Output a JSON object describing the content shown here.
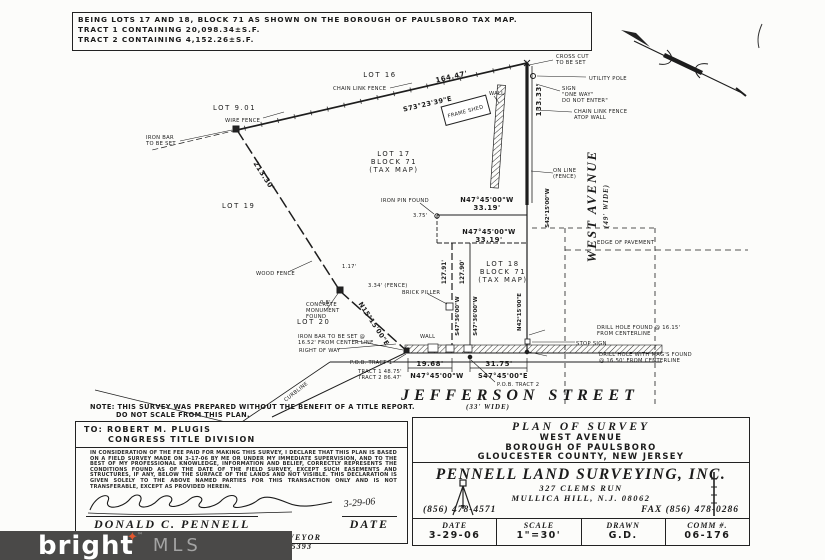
{
  "header": {
    "line1": "BEING LOTS 17 AND 18, BLOCK 71 AS SHOWN ON THE BOROUGH OF PAULSBORO TAX MAP.",
    "line2": "TRACT 1 CONTAINING 20,098.34±S.F.",
    "line3": "TRACT 2 CONTAINING 4,152.26±S.F."
  },
  "drawing": {
    "labels": {
      "l_lot16": "LOT 16",
      "l_clf": "CHAIN LINK FENCE",
      "l_16447": "164.47'",
      "l_s7323": "S73°23'39\"E",
      "l_lot901": "LOT 9.01",
      "l_wirefence": "WIRE FENCE",
      "l_frameshed": "FRAME SHED",
      "l_wall1": "WALL",
      "l_crosscut1": "CROSS CUT",
      "l_crosscut2": "TO BE SET",
      "l_utilpole": "UTILITY POLE",
      "l_sign1": "SIGN",
      "l_sign2": "\"ONE WAY\"",
      "l_sign3": "DO NOT ENTER\"",
      "l_clfwall1": "CHAIN LINK FENCE",
      "l_clfwall2": "ATOP WALL",
      "l_13333": "133.33'",
      "l_ironbar1a": "IRON BAR",
      "l_ironbar1b": "TO BE SET",
      "l_21330": "213.30'",
      "l_lot17a": "LOT 17",
      "l_lot17b": "BLOCK 71",
      "l_lot17c": "(TAX MAP)",
      "l_lot19": "LOT 19",
      "l_online1": "ON LINE",
      "l_online2": "(FENCE)",
      "l_s4215": "S42°15'00\"W",
      "l_westave": "WEST AVENUE",
      "l_westavewide": "(49' WIDE)",
      "l_edgepave": "EDGE OF PAVEMENT",
      "l_ironpin": "IRON PIN FOUND",
      "l_375": "3.75'",
      "l_n4745a": "N47°45'00\"W",
      "l_3319a": "33.19'",
      "l_n4745b": "N47°45'00\"W",
      "l_3319b": "33.19'",
      "l_lot18a": "LOT 18",
      "l_lot18b": "BLOCK 71",
      "l_lot18c": "(TAX MAP)",
      "l_woodfence": "WOOD FENCE",
      "l_brick": "BRICK PILLER",
      "l_n1515": "N15°15'00\"E",
      "l_concmon1": "CONCRETE",
      "l_concmon2": "MONUMENT",
      "l_concmon3": "FOUND",
      "l_lot20": "LOT 20",
      "l_ironbar2a": "IRON BAR TO BE SET @",
      "l_ironbar2b": "16.52' FROM CENTER LINE",
      "l_row": "RIGHT OF WAY",
      "l_117": "1.17'",
      "l_334": "3.34' (FENCE)",
      "l_08": "0.8'",
      "l_12791": "127.91'",
      "l_12790": "127.90'",
      "l_s4736a": "S47°36'00\"W",
      "l_s4736b": "S47°36'00\"W",
      "l_n4215": "N42°15'00\"E",
      "l_wall2": "WALL",
      "l_pob1": "P.O.B. TRACT 1",
      "l_tract1": "TRACT 1  48.75'",
      "l_tract2": "TRACT 2  86.47'",
      "l_1968": "19.68'",
      "l_n4745c": "N47°45'00\"W",
      "l_3175": "31.75'",
      "l_s4745": "S47°45'00\"E",
      "l_pob2": "P.O.B. TRACT 2",
      "l_jeff": "JEFFERSON STREET",
      "l_jeffwide": "(33' WIDE)",
      "l_drill1a": "DRILL HOLE FOUND @ 16.15'",
      "l_drill1b": "FROM CENTERLINE",
      "l_stop": "STOP SIGN",
      "l_drill2a": "DRILL HOLE WITH MAG'S FOUND",
      "l_drill2b": "@ 16.50' FROM CENTERLINE",
      "l_curb": "CURBLINE"
    }
  },
  "note": {
    "line1": "NOTE: THIS SURVEY WAS PREPARED WITHOUT THE BENEFIT OF A TITLE REPORT.",
    "line2": "DO NOT SCALE FROM THIS PLAN."
  },
  "to_block": {
    "line1": "TO:  ROBERT M. PLUGIS",
    "line2": "CONGRESS TITLE DIVISION"
  },
  "title_block": {
    "plan_title": "PLAN  OF  SURVEY",
    "street": "WEST AVENUE",
    "municipality": "BOROUGH OF PAULSBORO",
    "county": "GLOUCESTER COUNTY, NEW JERSEY"
  },
  "surveyor_block": {
    "company": "PENNELL LAND SURVEYING, INC.",
    "address1": "327 CLEMS RUN",
    "address2": "MULLICA HILL, N.J. 08062",
    "phone": "(856) 478-4571",
    "fax": "FAX (856) 478-0286"
  },
  "info_row": {
    "date_label": "DATE",
    "date_value": "3-29-06",
    "scale_label": "SCALE",
    "scale_value": "1\"=30'",
    "drawn_label": "DRAWN",
    "drawn_value": "G.D.",
    "comm_label": "COMM #.",
    "comm_value": "06-176"
  },
  "certification": {
    "text": "IN CONSIDERATION OF THE FEE PAID FOR MAKING THIS SURVEY, I DECLARE THAT THIS PLAN IS BASED ON A FIELD SURVEY MADE ON 3-17-06 BY ME OR UNDER MY IMMEDIATE SUPERVISION, AND TO THE BEST OF MY PROFESSIONAL KNOWLEDGE, INFORMATION AND BELIEF, CORRECTLY REPRESENTS THE CONDITIONS FOUND AS OF THE DATE OF THE FIELD SURVEY, EXCEPT SUCH EASEMENTS AND STRUCTURES, IF ANY, BELOW THE SURFACE OF THE LANDS AND NOT VISIBLE. THIS DECLARATION IS GIVEN SOLELY TO THE ABOVE NAMED PARTIES FOR THIS TRANSACTION ONLY AND IS NOT TRANSFERABLE, EXCEPT AS PROVIDED HEREIN.",
    "signature_date": "3-29-06",
    "name": "DONALD C. PENNELL",
    "date_label": "DATE",
    "title1": "PROFESSIONAL LAND SURVEYOR",
    "title2": "NEW JERSEY LICENSE #35393"
  },
  "watermark": {
    "brand": "bright",
    "suffix": "MLS",
    "tm": "™",
    "star": "✦"
  },
  "colors": {
    "accent": "#e4572e",
    "watermark_bg": "#4a4948",
    "ink": "#1b1b1b"
  }
}
